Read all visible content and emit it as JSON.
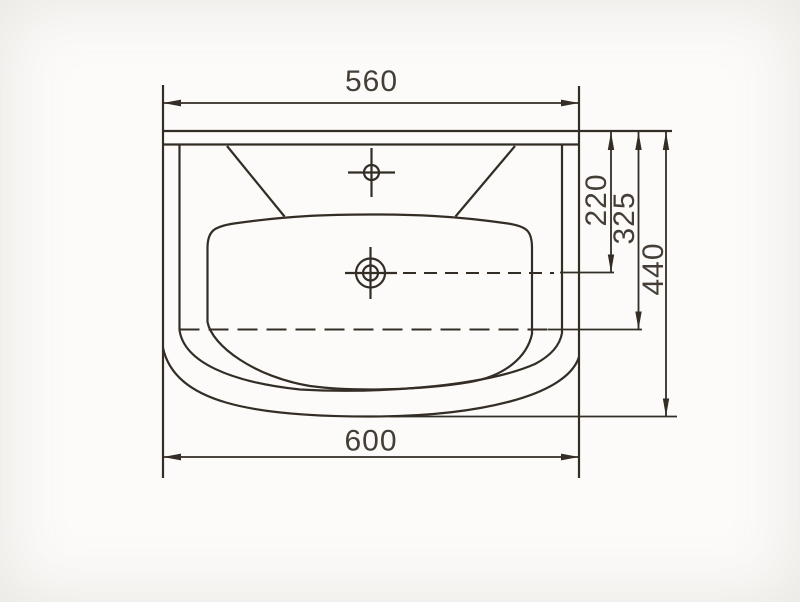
{
  "drawing": {
    "type": "technical-drawing",
    "subject": "washbasin top view",
    "line_color": "#332d26",
    "text_color": "#443e36",
    "background_color": "#fcfbf9",
    "dimensions": {
      "width_top": "560",
      "width_overall": "600",
      "depth_to_drain": "220",
      "depth_to_basin_edge": "325",
      "depth_overall": "440"
    }
  }
}
